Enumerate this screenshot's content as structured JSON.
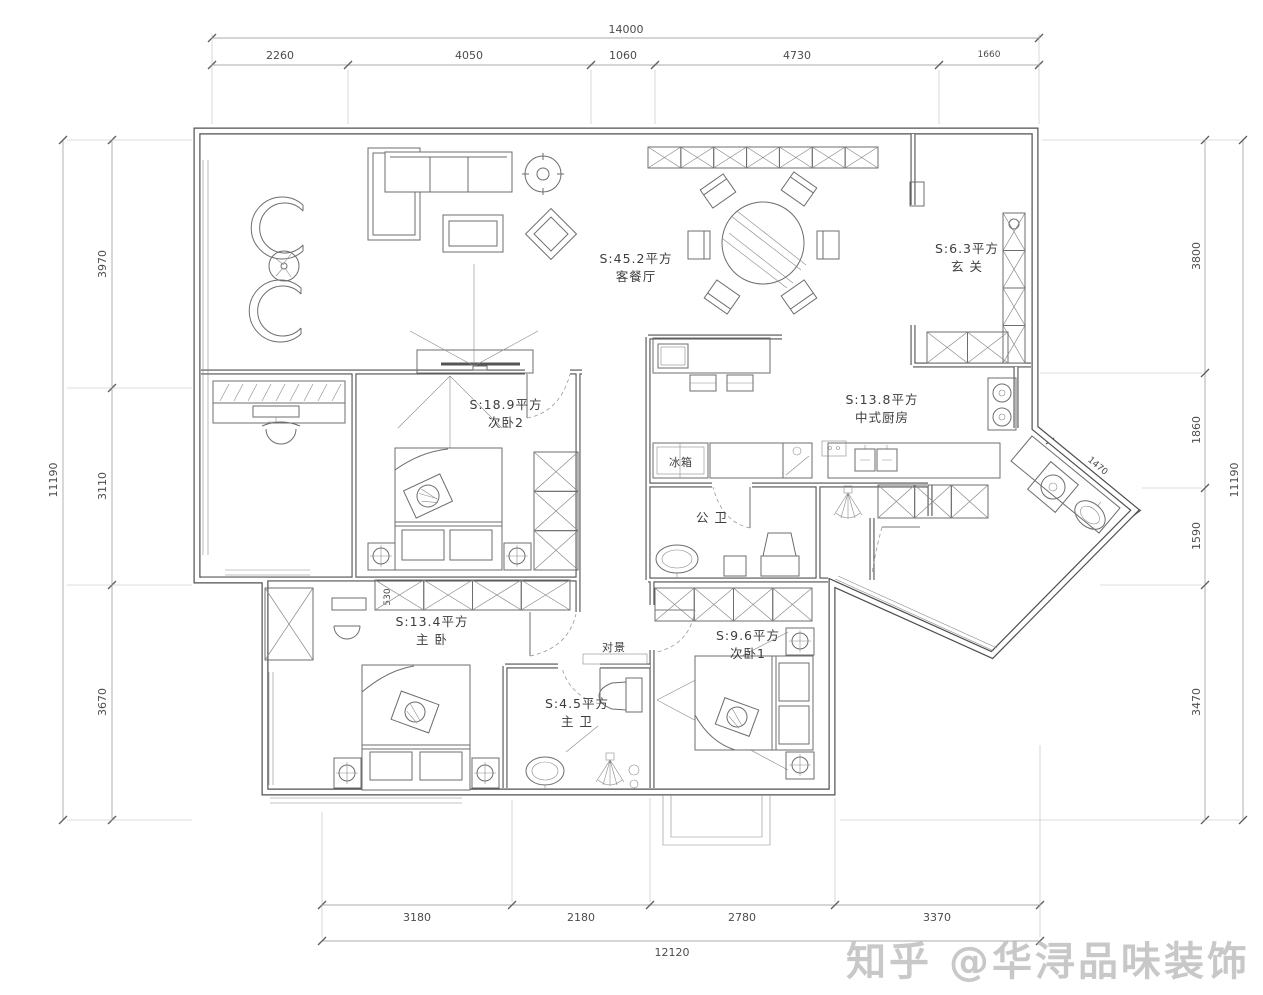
{
  "watermark": {
    "text": "知乎 @华浔品味装饰",
    "color": "#c8c8c8"
  },
  "dimensions": {
    "top": {
      "total": "14000",
      "segments": [
        "2260",
        "4050",
        "1060",
        "4730",
        "1660"
      ]
    },
    "left": {
      "total": "11190",
      "segments": [
        "3970",
        "3110",
        "3670"
      ]
    },
    "right": {
      "total": "11190",
      "segments": [
        "3800",
        "1860",
        "1590",
        "3470"
      ]
    },
    "bottom": {
      "total": "12120",
      "segments": [
        "3180",
        "2180",
        "2780",
        "3370"
      ]
    },
    "laundry_diagonal": "1470",
    "wardrobe_depth": "530"
  },
  "rooms": {
    "living_dining": {
      "area": "S:45.2平方",
      "name": "客餐厅"
    },
    "entrance": {
      "area": "S:6.3平方",
      "name": "玄 关"
    },
    "bedroom2": {
      "area": "S:18.9平方",
      "name": "次卧2"
    },
    "kitchen": {
      "area": "S:13.8平方",
      "name": "中式厨房"
    },
    "public_bath": {
      "name": "公 卫"
    },
    "master_bedroom": {
      "area": "S:13.4平方",
      "name": "主 卧"
    },
    "bedroom1": {
      "area": "S:9.6平方",
      "name": "次卧1"
    },
    "master_bath": {
      "area": "S:4.5平方",
      "name": "主 卫"
    }
  },
  "labels": {
    "fridge": "冰箱",
    "view_feature": "对景"
  },
  "colors": {
    "wall": "#4f4f4f",
    "furniture": "#6d6d6d",
    "dimension": "#8f8f8f",
    "text": "#3d3d3d",
    "background": "#ffffff"
  }
}
